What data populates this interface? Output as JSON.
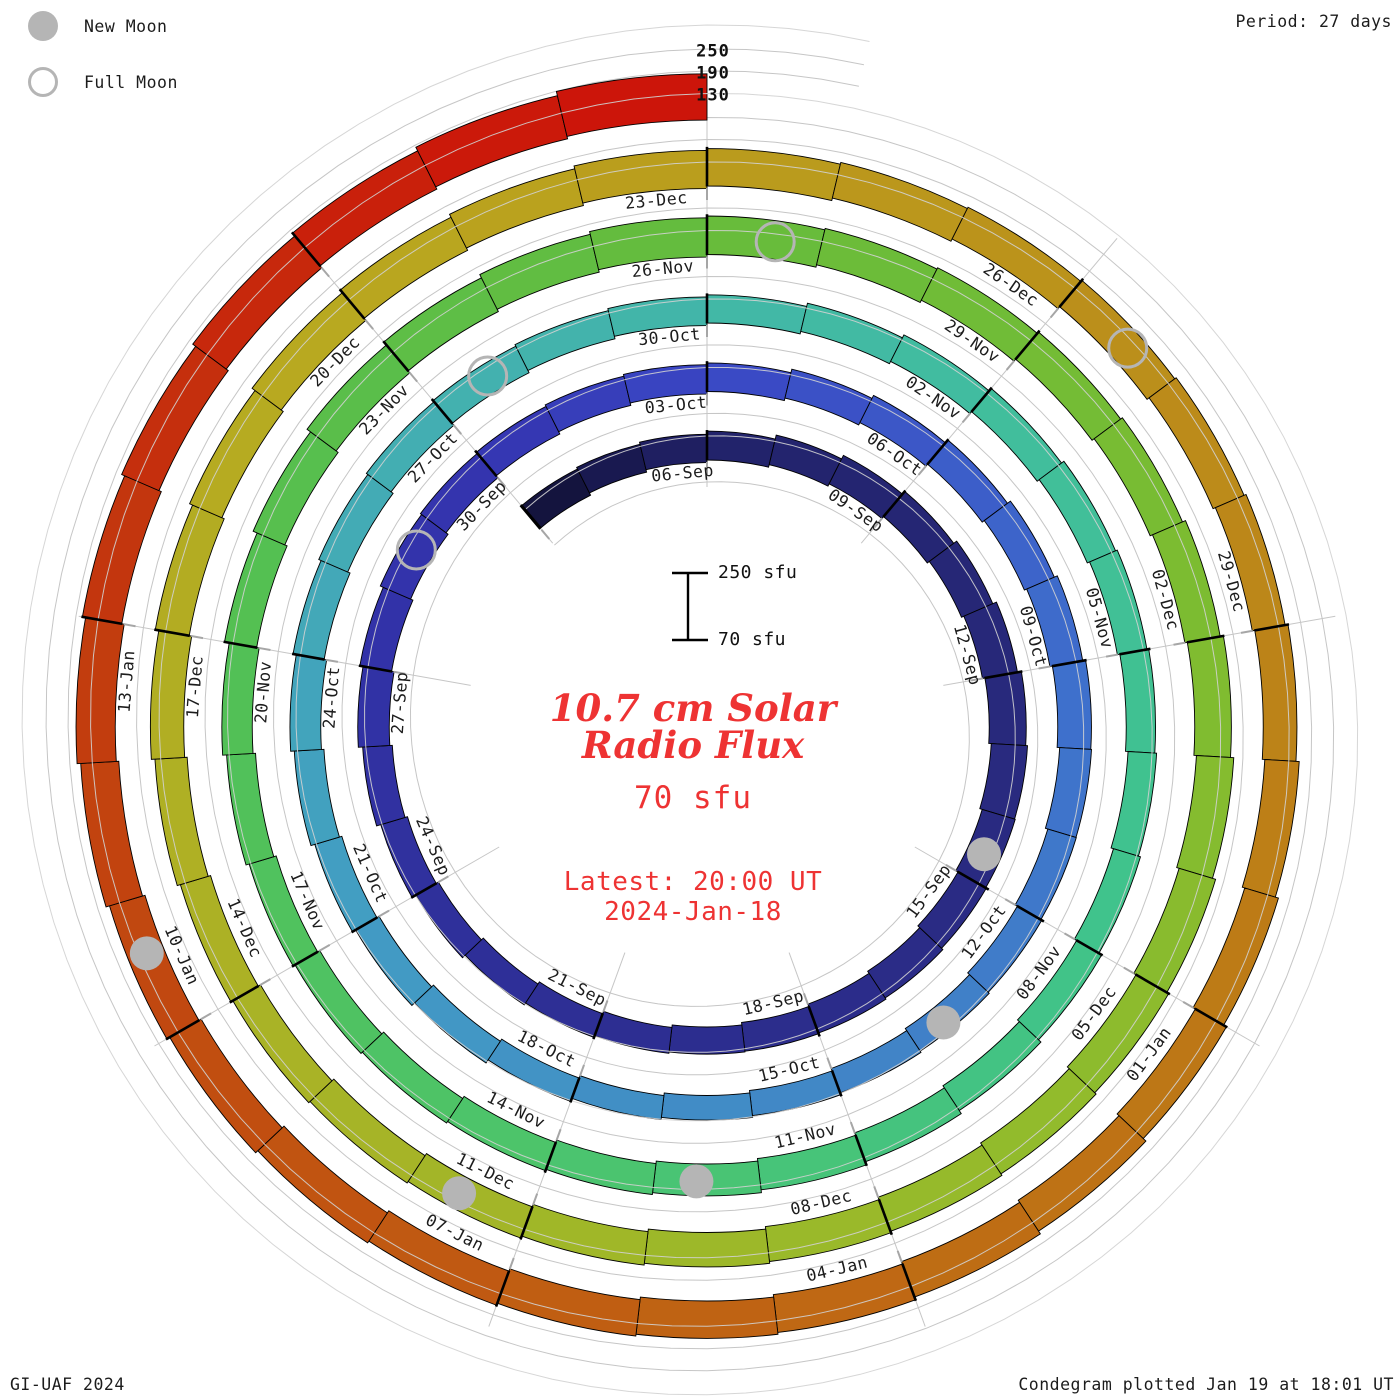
{
  "header": {
    "period_label": "Period: 27 days"
  },
  "legend": {
    "new_moon": "New Moon",
    "full_moon": "Full Moon"
  },
  "footer": {
    "left": "GI-UAF 2024",
    "right": "Condegram plotted Jan 19 at 18:01 UT"
  },
  "center": {
    "title_line1": "10.7 cm Solar",
    "title_line2": "Radio Flux",
    "current_value": "70 sfu",
    "latest_label": "Latest: 20:00 UT",
    "latest_date": "2024-Jan-18",
    "scalebar_top": "250 sfu",
    "scalebar_bottom": "70 sfu"
  },
  "colors": {
    "accent_red": "#ee3333",
    "moon_gray": "#b5b5b5",
    "grid_gray": "#c6c6c6",
    "tick_gray": "#a6a6a6",
    "label_black": "#1c1c1c"
  },
  "chart_data": {
    "type": "bar",
    "subtype": "condegram-spiral",
    "title": "10.7 cm Solar Radio Flux",
    "units": "sfu",
    "period_days": 27,
    "baseline_sfu": 70,
    "radial_axis_ticks_sfu": [
      250,
      190,
      130
    ],
    "radial_axis_tick_labels": [
      "250",
      "190",
      "130"
    ],
    "series": {
      "name": "F10.7 daily solar radio flux (sfu)",
      "start_date": "2023-09-03",
      "end_date": "2024-01-18",
      "values": [
        150,
        148,
        147,
        149,
        153,
        157,
        160,
        163,
        167,
        171,
        169,
        164,
        159,
        157,
        154,
        149,
        144,
        141,
        139,
        138,
        141,
        146,
        151,
        156,
        158,
        160,
        157,
        154,
        152,
        150,
        148,
        151,
        153,
        156,
        159,
        161,
        162,
        157,
        151,
        147,
        144,
        141,
        139,
        137,
        136,
        138,
        141,
        144,
        147,
        151,
        154,
        156,
        156,
        154,
        151,
        149,
        148,
        147,
        149,
        151,
        153,
        154,
        152,
        150,
        148,
        147,
        149,
        151,
        154,
        156,
        157,
        155,
        152,
        150,
        148,
        147,
        149,
        153,
        159,
        164,
        169,
        173,
        176,
        177,
        175,
        172,
        169,
        167,
        166,
        168,
        170,
        172,
        174,
        173,
        171,
        169,
        166,
        164,
        162,
        161,
        159,
        157,
        156,
        158,
        161,
        164,
        166,
        169,
        171,
        173,
        174,
        172,
        170,
        167,
        164,
        162,
        161,
        162,
        164,
        166,
        168,
        171,
        173,
        174,
        172,
        170,
        169,
        168,
        169,
        171,
        174,
        177,
        179,
        181,
        184,
        187,
        191,
        196
      ]
    },
    "spoke_labels": [
      {
        "text": "06-Sep",
        "day": 0
      },
      {
        "text": "03-Oct",
        "day": 27
      },
      {
        "text": "30-Oct",
        "day": 54
      },
      {
        "text": "26-Nov",
        "day": 81
      },
      {
        "text": "23-Dec",
        "day": 108
      },
      {
        "text": "09-Sep",
        "day": 3
      },
      {
        "text": "06-Oct",
        "day": 30
      },
      {
        "text": "02-Nov",
        "day": 57
      },
      {
        "text": "29-Nov",
        "day": 84
      },
      {
        "text": "26-Dec",
        "day": 111
      },
      {
        "text": "12-Sep",
        "day": 6
      },
      {
        "text": "09-Oct",
        "day": 33
      },
      {
        "text": "05-Nov",
        "day": 60
      },
      {
        "text": "02-Dec",
        "day": 87
      },
      {
        "text": "29-Dec",
        "day": 114
      },
      {
        "text": "15-Sep",
        "day": 9
      },
      {
        "text": "12-Oct",
        "day": 36
      },
      {
        "text": "08-Nov",
        "day": 63
      },
      {
        "text": "05-Dec",
        "day": 90
      },
      {
        "text": "01-Jan",
        "day": 117
      },
      {
        "text": "18-Sep",
        "day": 12
      },
      {
        "text": "15-Oct",
        "day": 39
      },
      {
        "text": "11-Nov",
        "day": 66
      },
      {
        "text": "08-Dec",
        "day": 93
      },
      {
        "text": "04-Jan",
        "day": 120
      },
      {
        "text": "21-Sep",
        "day": 15
      },
      {
        "text": "18-Oct",
        "day": 42
      },
      {
        "text": "14-Nov",
        "day": 69
      },
      {
        "text": "11-Dec",
        "day": 96
      },
      {
        "text": "07-Jan",
        "day": 123
      },
      {
        "text": "24-Sep",
        "day": 18
      },
      {
        "text": "21-Oct",
        "day": 45
      },
      {
        "text": "17-Nov",
        "day": 72
      },
      {
        "text": "14-Dec",
        "day": 99
      },
      {
        "text": "10-Jan",
        "day": 126
      },
      {
        "text": "27-Sep",
        "day": 21
      },
      {
        "text": "24-Oct",
        "day": 48
      },
      {
        "text": "20-Nov",
        "day": 75
      },
      {
        "text": "17-Dec",
        "day": 102
      },
      {
        "text": "13-Jan",
        "day": 129
      },
      {
        "text": "30-Sep",
        "day": 24
      },
      {
        "text": "27-Oct",
        "day": 51
      },
      {
        "text": "23-Nov",
        "day": 78
      },
      {
        "text": "20-Dec",
        "day": 105
      }
    ],
    "moons": [
      {
        "type": "new",
        "date": "15-Sep",
        "day": 9
      },
      {
        "type": "full",
        "date": "29-Sep",
        "day": 23
      },
      {
        "type": "new",
        "date": "14-Oct",
        "day": 38
      },
      {
        "type": "full",
        "date": "28-Oct",
        "day": 52
      },
      {
        "type": "new",
        "date": "13-Nov",
        "day": 68
      },
      {
        "type": "full",
        "date": "27-Nov",
        "day": 82
      },
      {
        "type": "new",
        "date": "12-Dec",
        "day": 97
      },
      {
        "type": "full",
        "date": "27-Dec",
        "day": 112
      },
      {
        "type": "new",
        "date": "11-Jan",
        "day": 127
      }
    ],
    "color_stops": [
      {
        "day": -4,
        "color": "#0b0b24"
      },
      {
        "day": 0,
        "color": "#22226a"
      },
      {
        "day": 8,
        "color": "#292a80"
      },
      {
        "day": 16,
        "color": "#2e2f96"
      },
      {
        "day": 24,
        "color": "#3434b0"
      },
      {
        "day": 27,
        "color": "#3a47c4"
      },
      {
        "day": 33,
        "color": "#3e6ecc"
      },
      {
        "day": 39,
        "color": "#4186c6"
      },
      {
        "day": 45,
        "color": "#429cc4"
      },
      {
        "day": 51,
        "color": "#43b0b0"
      },
      {
        "day": 57,
        "color": "#41bd9e"
      },
      {
        "day": 63,
        "color": "#40c38a"
      },
      {
        "day": 69,
        "color": "#4cc46c"
      },
      {
        "day": 75,
        "color": "#52c054"
      },
      {
        "day": 81,
        "color": "#66bc3c"
      },
      {
        "day": 87,
        "color": "#7ebc30"
      },
      {
        "day": 93,
        "color": "#98ba2a"
      },
      {
        "day": 99,
        "color": "#abb226"
      },
      {
        "day": 105,
        "color": "#b9a81f"
      },
      {
        "day": 111,
        "color": "#bb911b"
      },
      {
        "day": 117,
        "color": "#bd7916"
      },
      {
        "day": 123,
        "color": "#c05c12"
      },
      {
        "day": 129,
        "color": "#c23a0e"
      },
      {
        "day": 134,
        "color": "#cc150a"
      }
    ]
  }
}
